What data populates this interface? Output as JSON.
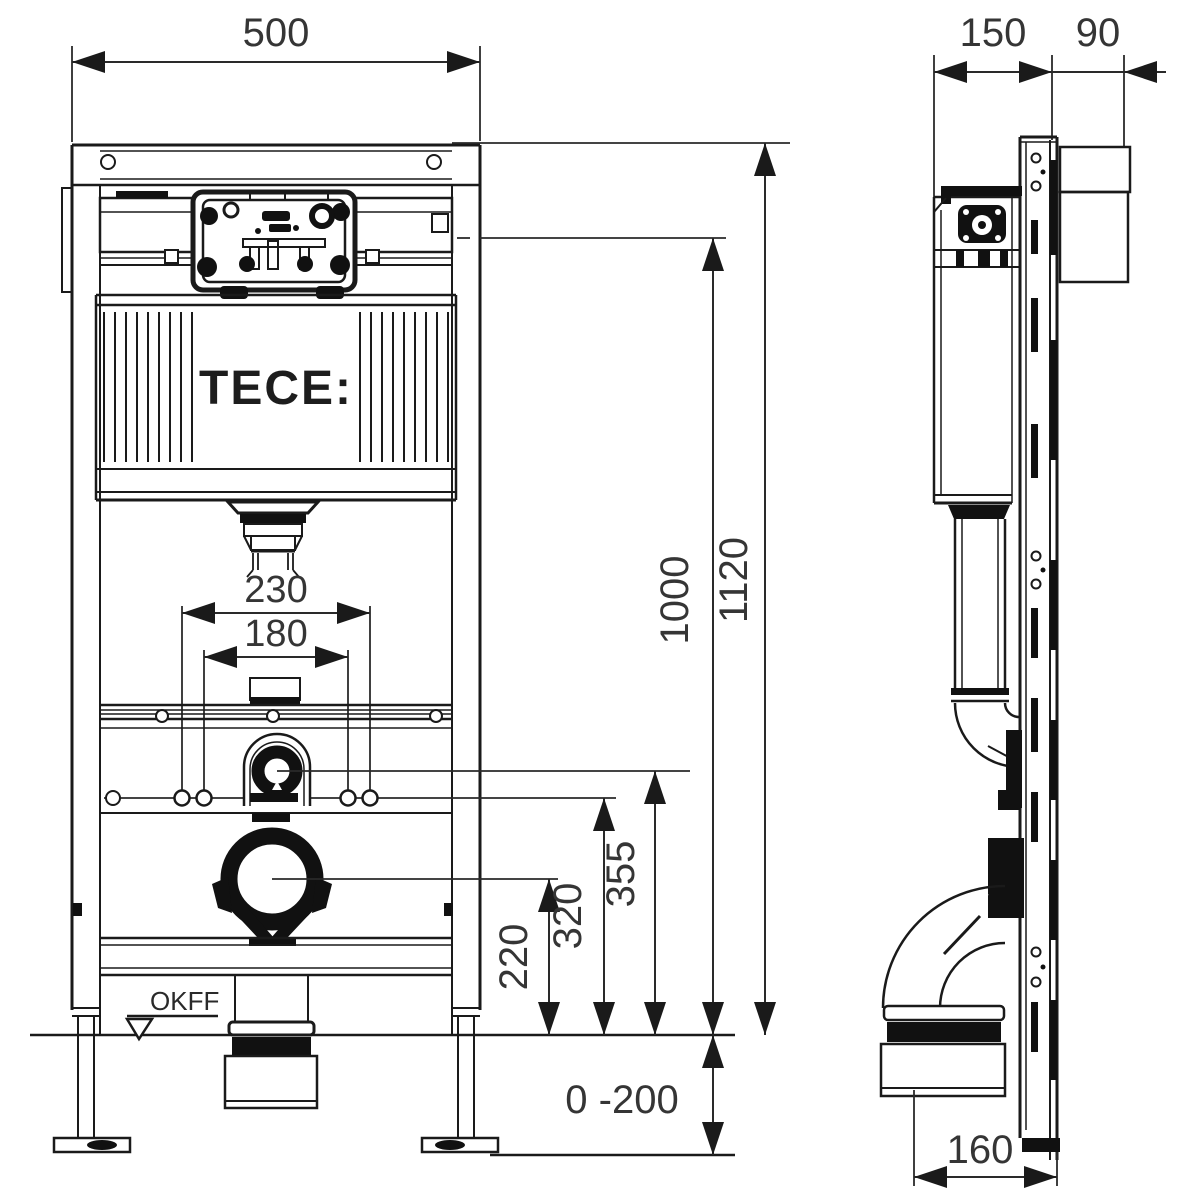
{
  "front": {
    "logo": "TECE:",
    "floor_label": "OKFF",
    "dims": {
      "width": "500",
      "total_height": "1120",
      "upper_height": "1000",
      "rods_outer": "230",
      "rods_inner": "180",
      "flush_bend_height": "355",
      "rods_height": "320",
      "drain_height": "220",
      "floor_adjust": "0 -200"
    }
  },
  "side": {
    "dims": {
      "frame_depth": "150",
      "wall_clearance": "90",
      "drain_offset": "160"
    }
  }
}
